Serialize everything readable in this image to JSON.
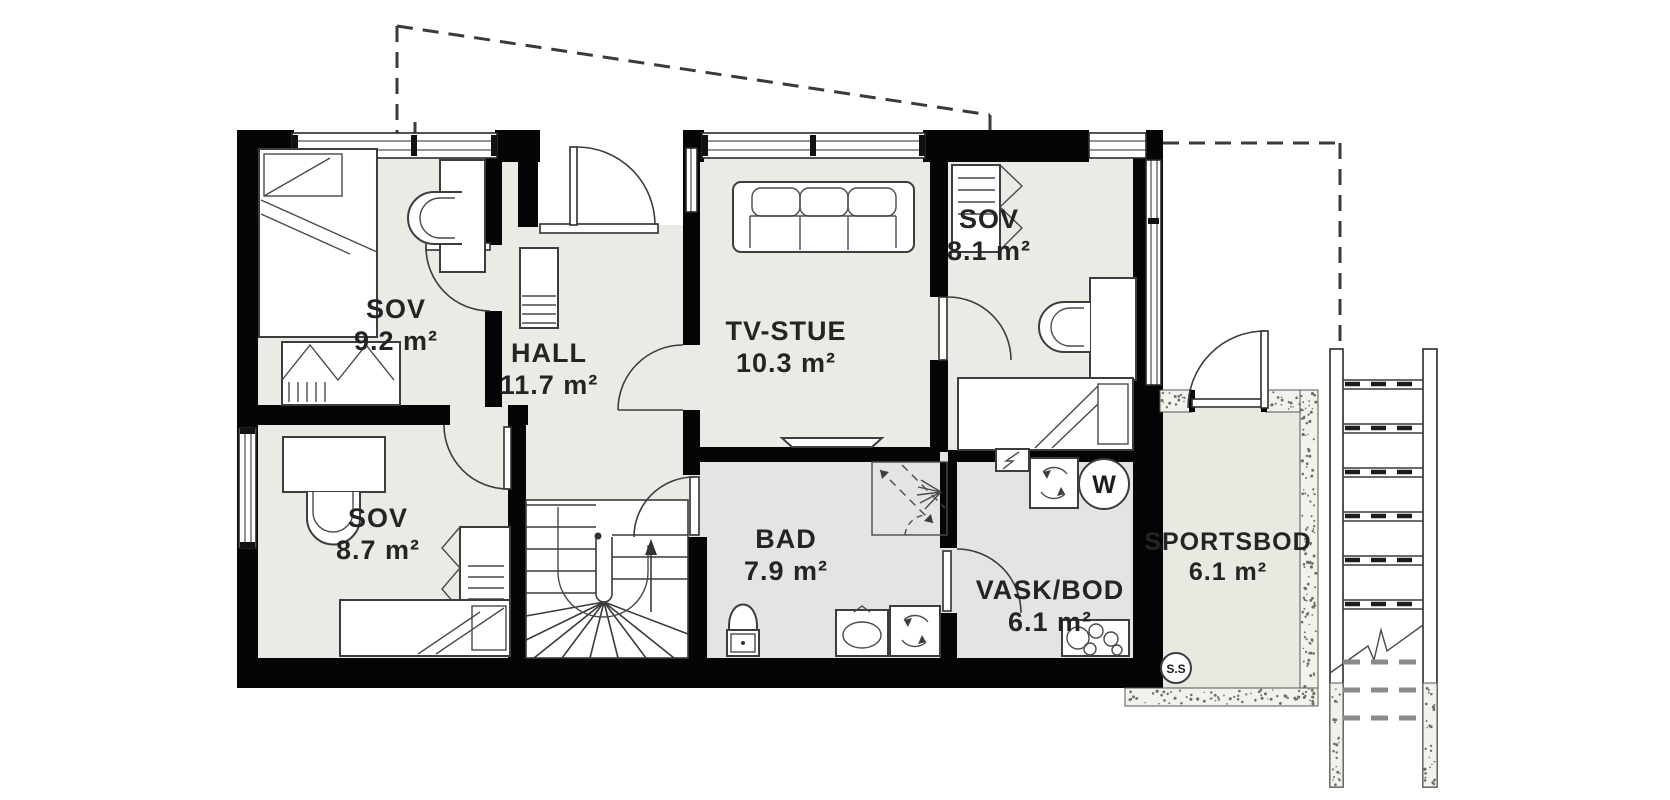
{
  "plan": {
    "type": "floor-plan",
    "rooms": [
      {
        "id": "sov-9-2",
        "name": "SOV",
        "area": "9.2 m²"
      },
      {
        "id": "hall",
        "name": "HALL",
        "area": "11.7 m²"
      },
      {
        "id": "tv-stue",
        "name": "TV-STUE",
        "area": "10.3 m²"
      },
      {
        "id": "sov-8-1",
        "name": "SOV",
        "area": "8.1 m²"
      },
      {
        "id": "sov-8-7",
        "name": "SOV",
        "area": "8.7 m²"
      },
      {
        "id": "bad",
        "name": "BAD",
        "area": "7.9 m²"
      },
      {
        "id": "vask-bod",
        "name": "VASK/BOD",
        "area": "6.1 m²"
      },
      {
        "id": "sportsbod",
        "name": "SPORTSBOD",
        "area": "6.1 m²"
      }
    ],
    "markers": {
      "water_heater": "W",
      "cold_storage": "S.S"
    },
    "colors": {
      "wall": "#050505",
      "room_fill": "#ebebe5",
      "wet_room_fill": "#e4e4e6",
      "storage_fill": "#e9e9e2",
      "speckle_wall": "#f2f1eb",
      "dashed_line": "#3a3a3a",
      "label_text": "#242424"
    }
  }
}
